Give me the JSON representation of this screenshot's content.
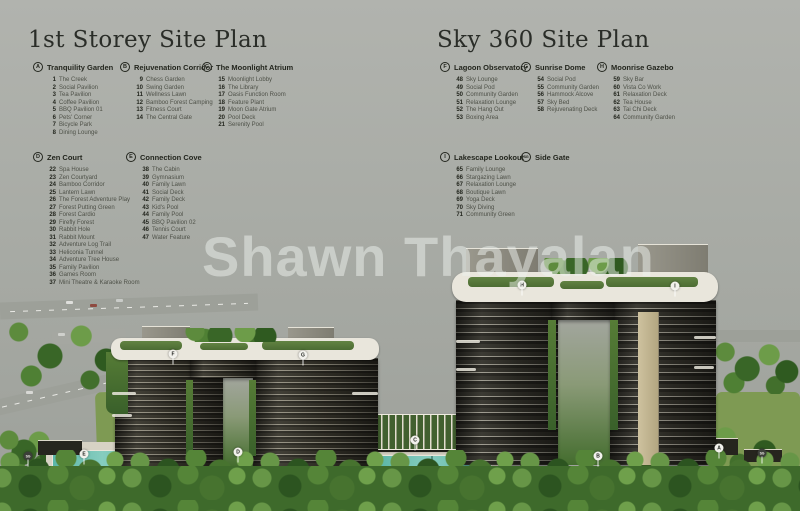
{
  "watermark": "Shawn Thayalan",
  "colors": {
    "background": "#a8aba5",
    "legend_text": "#23261e",
    "legend_item_text": "#4e5148",
    "pool": "#55b1a1",
    "foliage": "#3e6a2b",
    "marker_bg": "#f2f1ec"
  },
  "plans": [
    {
      "title": "1st Storey Site Plan",
      "title_x": 28,
      "title_y": 27,
      "sections": [
        {
          "letter": "A",
          "name": "Tranquility Garden",
          "x": 33,
          "y": 62,
          "items": [
            {
              "num": "1",
              "label": "The Creek"
            },
            {
              "num": "2",
              "label": "Social Pavilion"
            },
            {
              "num": "3",
              "label": "Tea Pavilion"
            },
            {
              "num": "4",
              "label": "Coffee Pavilion"
            },
            {
              "num": "5",
              "label": "BBQ Pavilion 01"
            },
            {
              "num": "6",
              "label": "Pets' Corner"
            },
            {
              "num": "7",
              "label": "Bicycle Park"
            },
            {
              "num": "8",
              "label": "Dining Lounge"
            }
          ]
        },
        {
          "letter": "B",
          "name": "Rejuvenation Corridor",
          "x": 120,
          "y": 62,
          "items": [
            {
              "num": "9",
              "label": "Chess Garden"
            },
            {
              "num": "10",
              "label": "Swing Garden"
            },
            {
              "num": "11",
              "label": "Wellness Lawn"
            },
            {
              "num": "12",
              "label": "Bamboo Forest Camping"
            },
            {
              "num": "13",
              "label": "Fitness Court"
            },
            {
              "num": "14",
              "label": "The Central Gate"
            }
          ]
        },
        {
          "letter": "C",
          "name": "The Moonlight Atrium",
          "x": 202,
          "y": 62,
          "items": [
            {
              "num": "15",
              "label": "Moonlight Lobby"
            },
            {
              "num": "16",
              "label": "The Library"
            },
            {
              "num": "17",
              "label": "Oasis Function Room"
            },
            {
              "num": "18",
              "label": "Feature Plant"
            },
            {
              "num": "19",
              "label": "Moon Gate Atrium"
            },
            {
              "num": "20",
              "label": "Pool Deck"
            },
            {
              "num": "21",
              "label": "Serenity Pool"
            }
          ]
        },
        {
          "letter": "D",
          "name": "Zen Court",
          "x": 33,
          "y": 152,
          "items": [
            {
              "num": "22",
              "label": "Spa House"
            },
            {
              "num": "23",
              "label": "Zen Courtyard"
            },
            {
              "num": "24",
              "label": "Bamboo Corridor"
            },
            {
              "num": "25",
              "label": "Lantern Lawn"
            },
            {
              "num": "26",
              "label": "The Forest Adventure Play"
            },
            {
              "num": "27",
              "label": "Forest Putting Green"
            },
            {
              "num": "28",
              "label": "Forest Cardio"
            },
            {
              "num": "29",
              "label": "Firefly Forest"
            },
            {
              "num": "30",
              "label": "Rabbit Hole"
            },
            {
              "num": "31",
              "label": "Rabbit Mount"
            },
            {
              "num": "32",
              "label": "Adventure Log Trail"
            },
            {
              "num": "33",
              "label": "Heliconia Tunnel"
            },
            {
              "num": "34",
              "label": "Adventure Tree House"
            },
            {
              "num": "35",
              "label": "Family Pavilion"
            },
            {
              "num": "36",
              "label": "Games Room"
            },
            {
              "num": "37",
              "label": "Mini Theatre & Karaoke Room"
            }
          ]
        },
        {
          "letter": "E",
          "name": "Connection Cove",
          "x": 126,
          "y": 152,
          "items": [
            {
              "num": "38",
              "label": "The Cabin"
            },
            {
              "num": "39",
              "label": "Gymnasium"
            },
            {
              "num": "40",
              "label": "Family Lawn"
            },
            {
              "num": "41",
              "label": "Social Deck"
            },
            {
              "num": "42",
              "label": "Family Deck"
            },
            {
              "num": "43",
              "label": "Kid's Pool"
            },
            {
              "num": "44",
              "label": "Family Pool"
            },
            {
              "num": "45",
              "label": "BBQ Pavilion 02"
            },
            {
              "num": "46",
              "label": "Tennis Court"
            },
            {
              "num": "47",
              "label": "Water Feature"
            }
          ]
        }
      ]
    },
    {
      "title": "Sky 360 Site Plan",
      "title_x": 437,
      "title_y": 27,
      "sections": [
        {
          "letter": "F",
          "name": "Lagoon Observatory",
          "x": 440,
          "y": 62,
          "items": [
            {
              "num": "48",
              "label": "Sky Lounge"
            },
            {
              "num": "49",
              "label": "Social Pod"
            },
            {
              "num": "50",
              "label": "Community Garden"
            },
            {
              "num": "51",
              "label": "Relaxation Lounge"
            },
            {
              "num": "52",
              "label": "The Hang Out"
            },
            {
              "num": "53",
              "label": "Boxing Area"
            }
          ]
        },
        {
          "letter": "G",
          "name": "Sunrise Dome",
          "x": 521,
          "y": 62,
          "items": [
            {
              "num": "54",
              "label": "Social Pod"
            },
            {
              "num": "55",
              "label": "Community Garden"
            },
            {
              "num": "56",
              "label": "Hammock Alcove"
            },
            {
              "num": "57",
              "label": "Sky Bed"
            },
            {
              "num": "58",
              "label": "Rejuvenating Deck"
            }
          ]
        },
        {
          "letter": "H",
          "name": "Moonrise Gazebo",
          "x": 597,
          "y": 62,
          "items": [
            {
              "num": "59",
              "label": "Sky Bar"
            },
            {
              "num": "60",
              "label": "Vista Co Work"
            },
            {
              "num": "61",
              "label": "Relaxation Deck"
            },
            {
              "num": "62",
              "label": "Tea House"
            },
            {
              "num": "63",
              "label": "Tai Chi Deck"
            },
            {
              "num": "64",
              "label": "Community Garden"
            }
          ]
        },
        {
          "letter": "I",
          "name": "Lakescape Lookout",
          "x": 440,
          "y": 152,
          "items": [
            {
              "num": "65",
              "label": "Family Lounge"
            },
            {
              "num": "66",
              "label": "Stargazing Lawn"
            },
            {
              "num": "67",
              "label": "Relaxation Lounge"
            },
            {
              "num": "68",
              "label": "Boutique Lawn"
            },
            {
              "num": "69",
              "label": "Yoga Deck"
            },
            {
              "num": "70",
              "label": "Sky Diving"
            },
            {
              "num": "71",
              "label": "Community Green"
            }
          ]
        },
        {
          "letter": "SG",
          "name": "Side Gate",
          "x": 521,
          "y": 152,
          "items": []
        }
      ]
    }
  ],
  "markers": [
    {
      "label": "F",
      "x": 173,
      "y": 354,
      "dark": false
    },
    {
      "label": "G",
      "x": 303,
      "y": 355,
      "dark": false
    },
    {
      "label": "H",
      "x": 522,
      "y": 285,
      "dark": false
    },
    {
      "label": "I",
      "x": 675,
      "y": 286,
      "dark": false
    },
    {
      "label": "E",
      "x": 84,
      "y": 454,
      "dark": false
    },
    {
      "label": "D",
      "x": 238,
      "y": 452,
      "dark": false
    },
    {
      "label": "C",
      "x": 415,
      "y": 440,
      "dark": false
    },
    {
      "label": "B",
      "x": 598,
      "y": 456,
      "dark": false
    },
    {
      "label": "A",
      "x": 719,
      "y": 448,
      "dark": false
    },
    {
      "label": "SG",
      "x": 28,
      "y": 456,
      "dark": true
    },
    {
      "label": "SG",
      "x": 762,
      "y": 453,
      "dark": true
    }
  ]
}
